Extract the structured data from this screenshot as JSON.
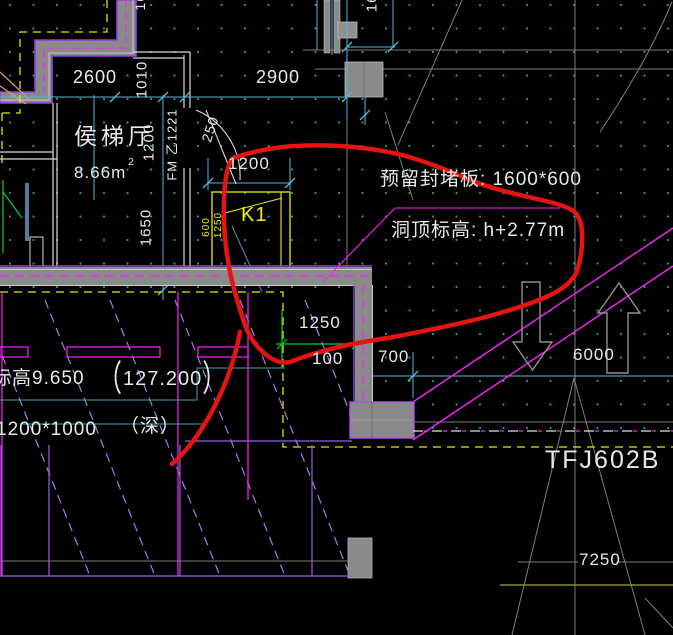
{
  "room": {
    "name": "侯梯厅",
    "area_value": "8.66m",
    "area_sup": "2"
  },
  "annotations": {
    "note_line1": "预留封堵板: 1600*600",
    "note_line2": "洞顶标高: h+2.77m"
  },
  "marks": {
    "opening_mark": "K1",
    "door_mark": "FM 乙1221",
    "equipment_mark": "TFJ602B",
    "depth_note": "（深）",
    "elevation": "标高9.650",
    "elevation_alt_open": "（",
    "elevation_alt_value": "127.200",
    "elevation_alt_close": "）",
    "pit_size": "1200*1000"
  },
  "dimensions": {
    "d2600": "2600",
    "d1010": "1010",
    "d2900": "2900",
    "d1680_top": "1680",
    "d1600_top": "1600",
    "d1200_vert": "1200",
    "d250_door": "250",
    "d1200_door": "1200",
    "d1650_left": "1650",
    "k1_dim_a": "600",
    "k1_dim_b": "1250",
    "d1250_green": "1250",
    "d100": "100",
    "d700": "700",
    "d6000": "6000",
    "d7250": "7250"
  },
  "colors": {
    "background": "#000000",
    "grid_dot": "#2a9494",
    "dim_cyan": "#54b8d8",
    "wall_gray": "#8a8a8a",
    "wall_purple": "#9040e0",
    "magenta": "#ff20ff",
    "hatch_purple": "#a878f0",
    "yellow": "#f0f000",
    "green_dim": "#00d02c",
    "red_markup": "#e41410",
    "text_white": "#e8e8e8"
  }
}
